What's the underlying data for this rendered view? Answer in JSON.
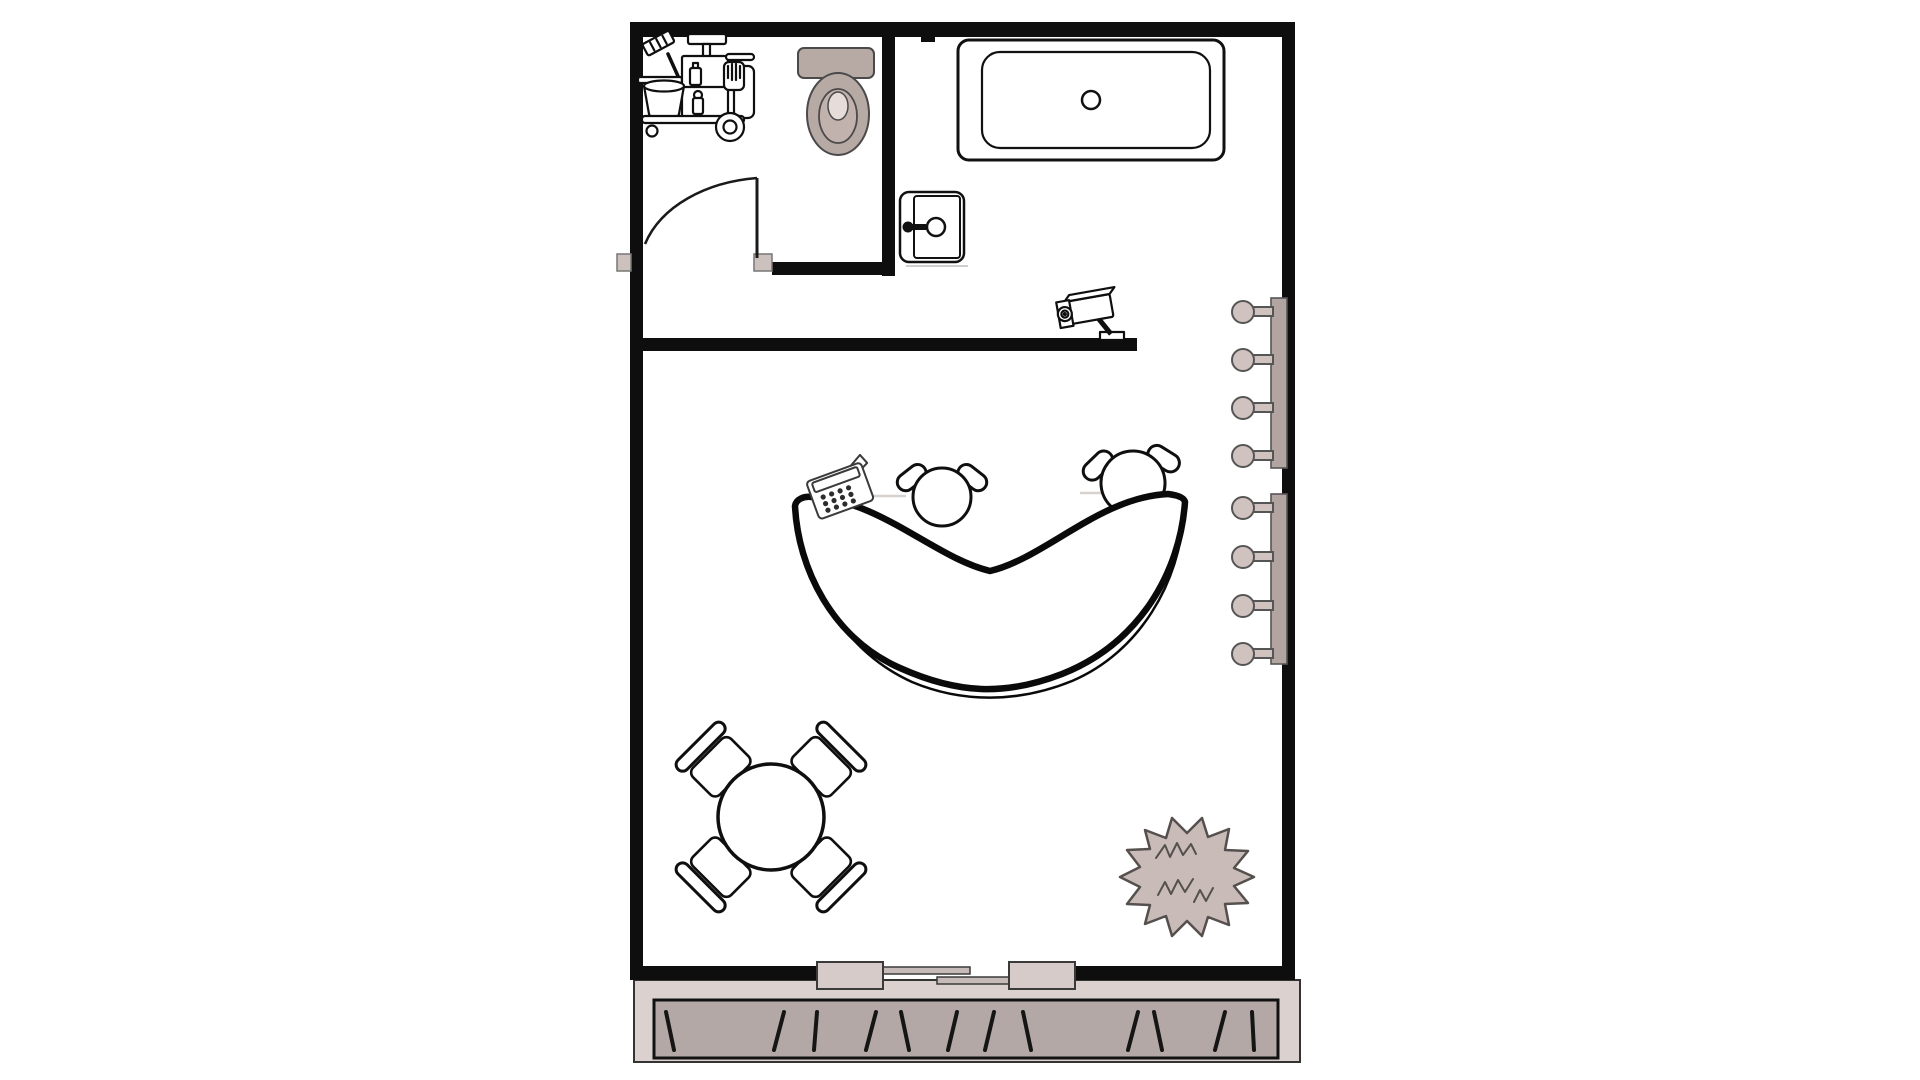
{
  "app": {
    "title": "Reception floor plan"
  },
  "colors": {
    "wall": "#0e0e0e",
    "line": "#0f0f0f",
    "taupe_fixture": "#b7a9a4",
    "toilet_seat_inner": "#c2b2ad",
    "toilet_lid_center": "#e6dcd9",
    "hook_knob": "#cfc2bf",
    "hook_rack": "#b2a5a1",
    "door_post": "#cdc1be",
    "mat_outer": "#dbd2cf",
    "mat_inner": "#b3a8a5",
    "door_panel": "#d6cbc8",
    "rail": "#c6bbb8",
    "plant_fill": "#c9bcb8",
    "plant_stroke": "#55504e",
    "shadow": "#cfcfcf"
  },
  "rooms": [
    {
      "name": "utility-room"
    },
    {
      "name": "bath-area"
    },
    {
      "name": "main-area"
    }
  ],
  "fixtures": [
    {
      "name": "cleaning-cart",
      "room": "utility-room"
    },
    {
      "name": "toilet",
      "room": "utility-room"
    },
    {
      "name": "swing-door",
      "room": "utility-room"
    },
    {
      "name": "bathtub",
      "room": "bath-area"
    },
    {
      "name": "safe",
      "room": "bath-area"
    },
    {
      "name": "security-camera",
      "room": "bath-area"
    },
    {
      "name": "coat-rack",
      "hooks": 4,
      "count": 2,
      "room": "main-area"
    },
    {
      "name": "reception-desk",
      "room": "main-area"
    },
    {
      "name": "office-chair",
      "count": 2,
      "room": "main-area"
    },
    {
      "name": "payment-terminal",
      "room": "main-area"
    },
    {
      "name": "round-table",
      "room": "main-area"
    },
    {
      "name": "dining-chair",
      "count": 4,
      "room": "main-area"
    },
    {
      "name": "plant",
      "room": "main-area"
    },
    {
      "name": "sliding-entrance-door",
      "panels": 2,
      "room": "main-area"
    },
    {
      "name": "entrance-mat",
      "room": "outside"
    }
  ]
}
